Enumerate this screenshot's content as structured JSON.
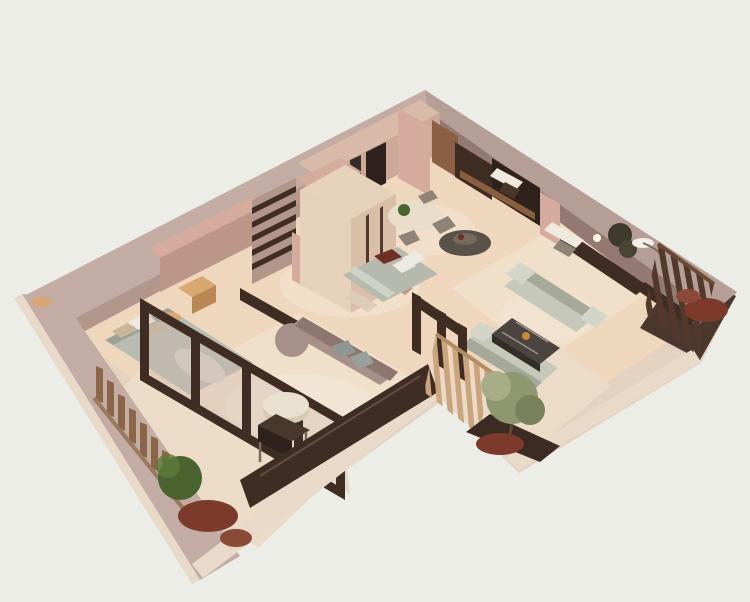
{
  "scene": {
    "kind": "isometric-3d-floor-plan-render",
    "rooms": [
      "kitchen-dining",
      "media-lounge",
      "office",
      "living-room",
      "bedroom-left",
      "bedroom-middle",
      "lounge-terrace",
      "hallway",
      "balcony-left",
      "balcony-right",
      "balcony-far-right"
    ]
  },
  "colors": {
    "background": "#ecede7",
    "shell": "#e4d2c1",
    "wallTopLight": "#c3aca3",
    "wallTopDark": "#b59e96",
    "wallFaceLight": "#b2958b",
    "wallFaceDark": "#937971",
    "wallPink": "#d4ab9c",
    "wallPinkDeep": "#bd968a",
    "floorWarm": "#eed7bc",
    "floorLit": "#f6e6cc",
    "floorTerrace": "#f0dfc9",
    "floorBalcony": "#ecdbc6",
    "parapetCream": "#e8d9c8",
    "darkWood": "#3f2d24",
    "mediaDark": "#2f211b",
    "woodShelf": "#8a5f3e",
    "slatDark": "#53392c",
    "slatMid": "#8a6548",
    "slatLight": "#c9a47d",
    "sofaSage": "#c6c9ba",
    "sofaSageShade": "#a6a99a",
    "sofaMauve": "#a78f8a",
    "sofaMauveShade": "#8d7570",
    "bedGray": "#b9bcb2",
    "bedSage": "#b6b9ad",
    "pillowWhite": "#eceae2",
    "pillowGray": "#8f9693",
    "pillowTan": "#c7b69a",
    "accentRed": "#6f3024",
    "woodLight": "#d9a76f",
    "woodLightSide": "#b98754",
    "wardrobeCream": "#e6d2ba",
    "wardrobeSide": "#d9bfa8",
    "cabinetPink": "#d9b9a8",
    "cabinetPinkFace": "#cda896",
    "tableCream": "#e8ddcb",
    "marbleDark": "#4c443e",
    "marbleSide": "#332c27",
    "ottomanCream": "#e9e0d0",
    "ottomanSide": "#d6c9b4",
    "stoolDark": "#4a372c",
    "greenBush": "#4b632f",
    "olive": "#8e976f",
    "oliveLight": "#a7ae87",
    "oliveDark": "#78815c",
    "redPlant": "#7c3a2b",
    "darkFloor": "#4a382e",
    "chairTaupe": "#8f8376",
    "lampGold": "#c6893f",
    "white": "#f0e9dd",
    "glassTint": "#cbb4a8",
    "doorTan": "#8a5f43"
  }
}
